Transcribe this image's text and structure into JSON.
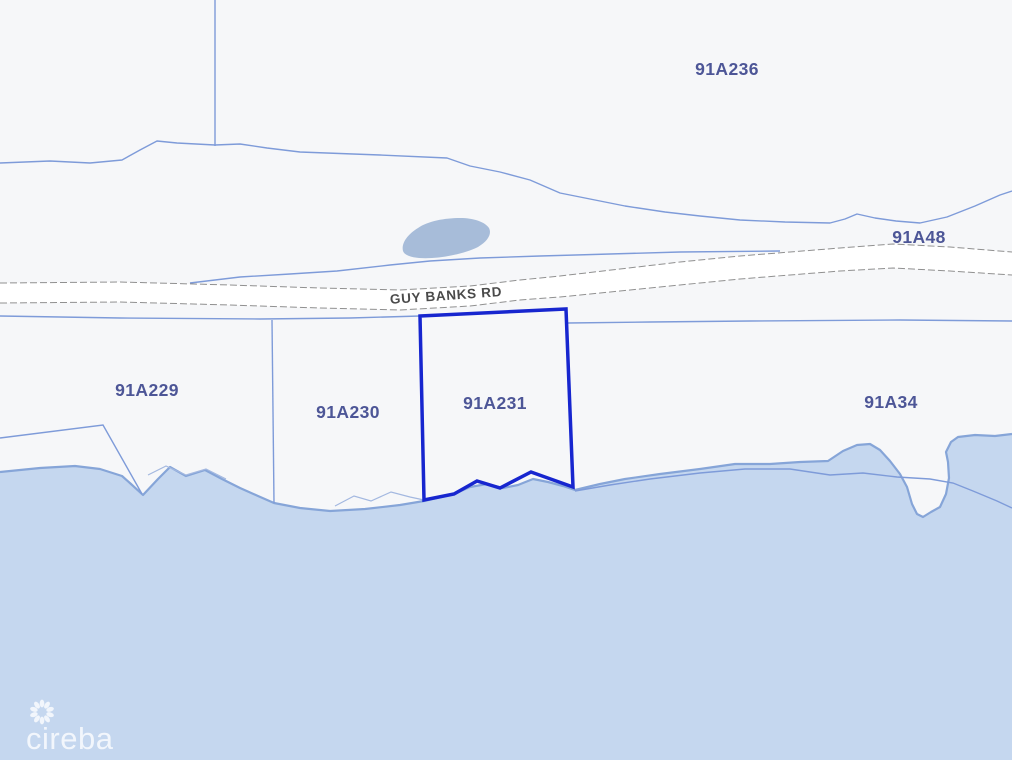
{
  "map": {
    "type": "cadastral-parcel-map",
    "road": {
      "name": "GUY BANKS RD"
    },
    "parcels": [
      {
        "label": "91A236",
        "highlighted": false
      },
      {
        "label": "91A48",
        "highlighted": false
      },
      {
        "label": "91A229",
        "highlighted": false
      },
      {
        "label": "91A230",
        "highlighted": false
      },
      {
        "label": "91A231",
        "highlighted": true
      },
      {
        "label": "91A34",
        "highlighted": false
      }
    ],
    "highlighted_parcel": "91A231",
    "colors": {
      "land": "#f6f7f9",
      "water": "#c5d7ef",
      "coastline": "#86a5d8",
      "boundary_line": "#7e9bd9",
      "minor_line": "#a3b8e0",
      "road_casing": "#909090",
      "road_fill": "#ffffff",
      "highlight": "#1726cf",
      "label": "#4d5697",
      "road_label": "#4a4a4a",
      "pond": "#a7bcd9",
      "watermark": "rgba(255,255,255,0.78)"
    }
  },
  "watermark": {
    "text": "cireba",
    "icon": "flower-burst-icon"
  }
}
